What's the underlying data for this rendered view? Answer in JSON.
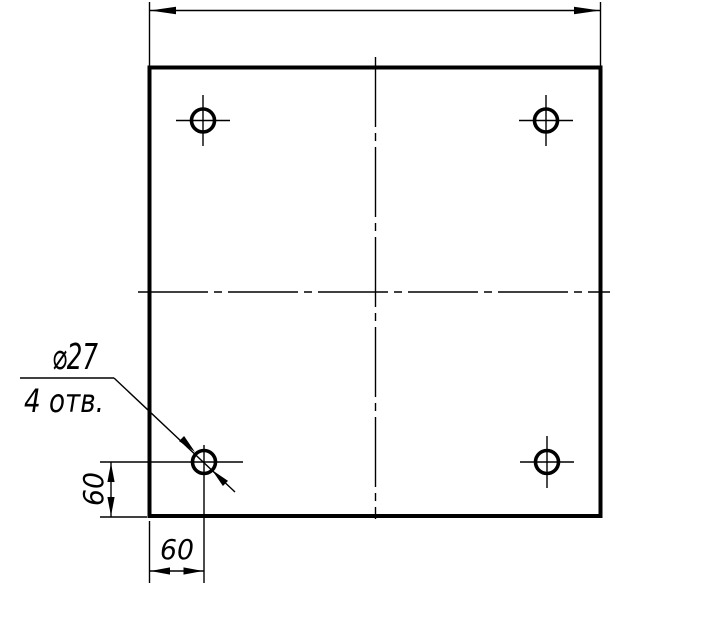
{
  "drawing": {
    "background": "#ffffff",
    "ink_color": "#000000",
    "leader_note": {
      "diameter": "⌀27",
      "holes_count": "4 отв."
    },
    "dimensions": {
      "hole_offset_from_left_edge": "60",
      "hole_offset_from_bottom_edge": "60"
    }
  }
}
